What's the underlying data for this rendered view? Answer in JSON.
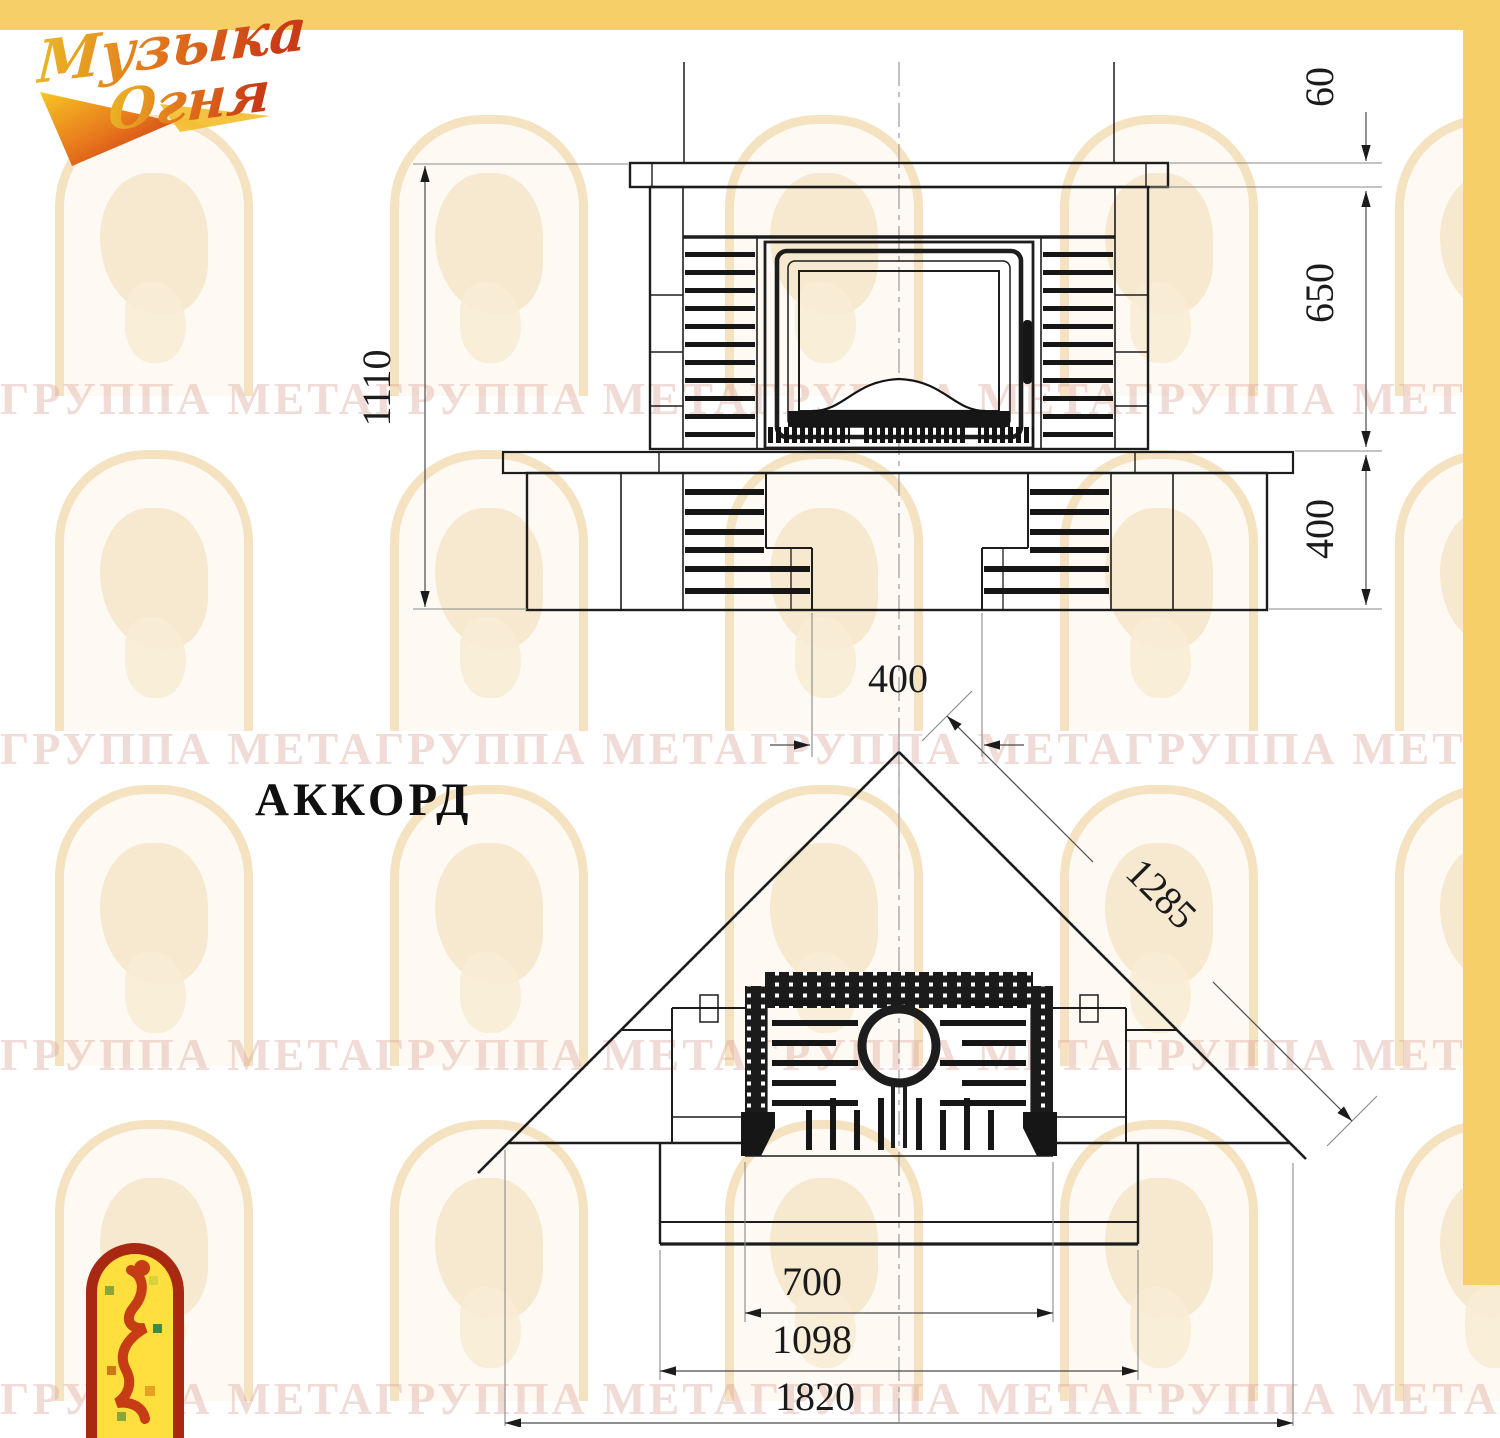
{
  "title": "АККОРД",
  "logo": {
    "brand_line1": "Музыка",
    "brand_line2": "Огня"
  },
  "watermark": {
    "text": "ГРУППА МЕТАГРУППА МЕТАГРУППА МЕТАГРУППА МЕТАГРУППА МЕТА"
  },
  "front_view": {
    "dims": {
      "height": "1110",
      "shelf_thickness": "60",
      "opening_height": "650",
      "base_height": "400",
      "niche_width": "400"
    }
  },
  "plan_view": {
    "dims": {
      "diagonal": "1285",
      "firebox_width": "700",
      "hearth_width": "1098",
      "overall_width": "1820"
    }
  },
  "colors": {
    "accent_yellow": "#f6cf69",
    "line": "#1d1d1d",
    "logo_red": "#a82812",
    "logo_yellow": "#ffdf3d"
  }
}
